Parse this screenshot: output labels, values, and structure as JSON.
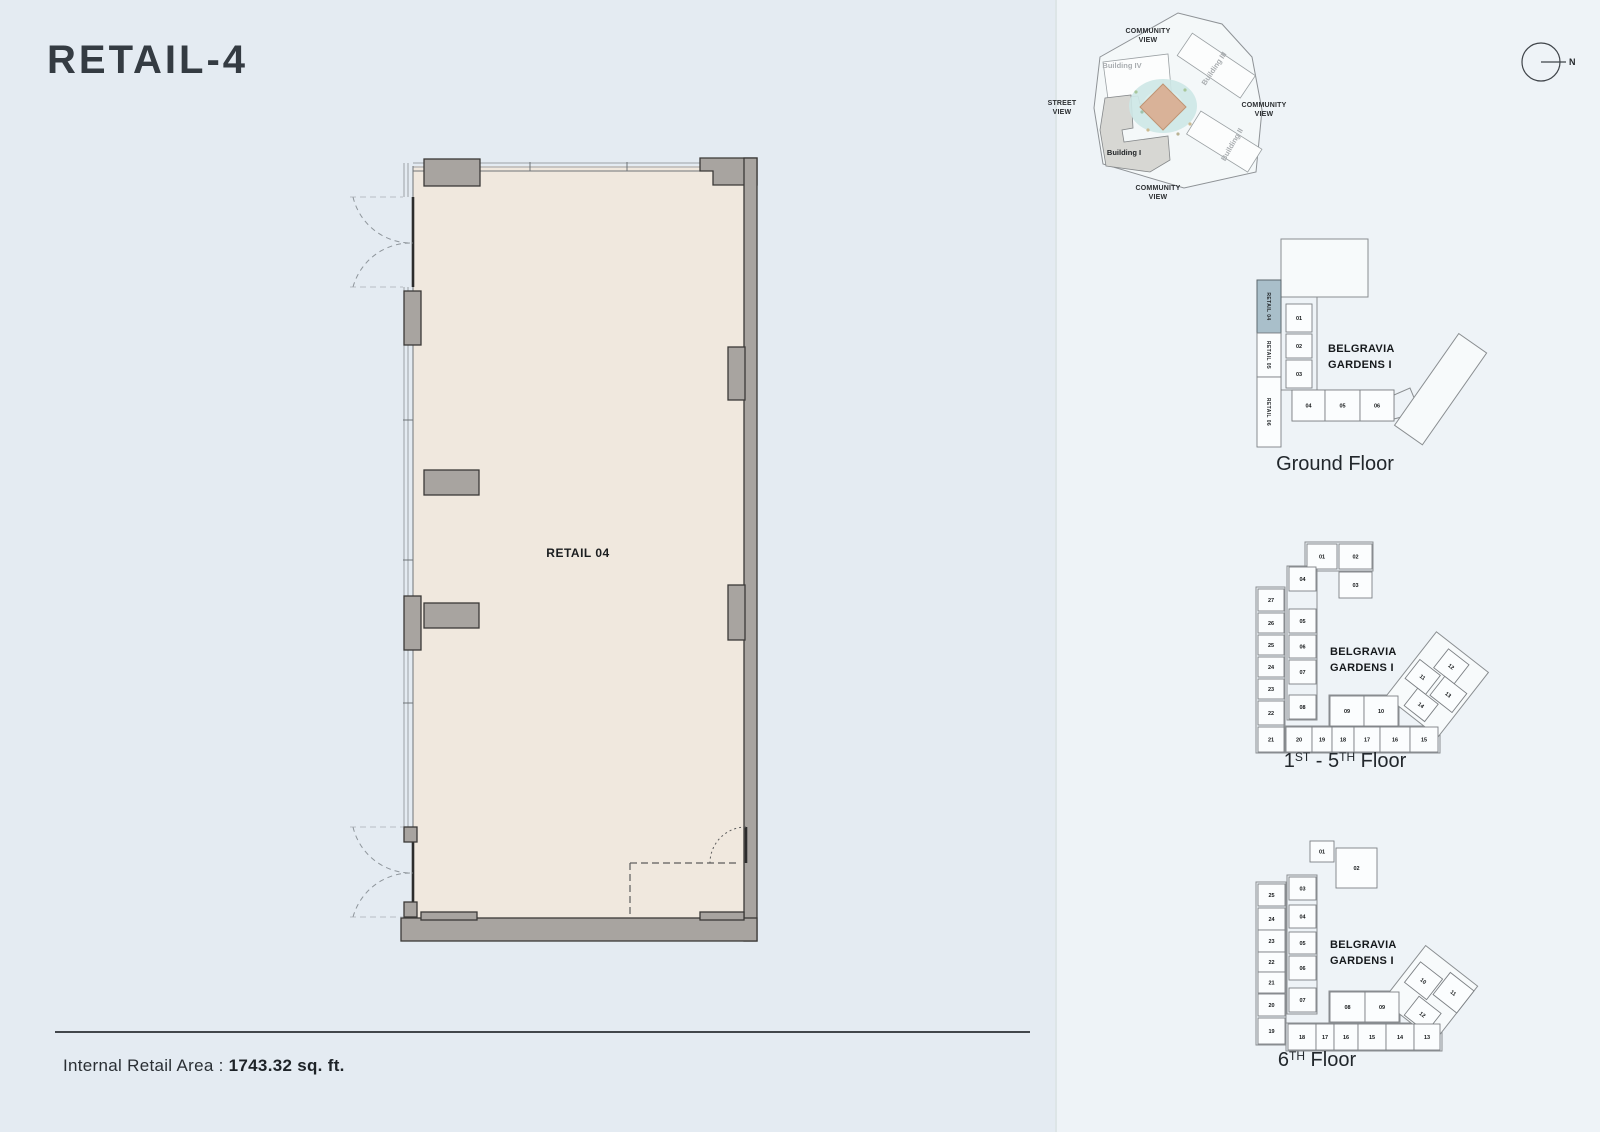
{
  "page": {
    "title": "RETAIL-4",
    "area_label": "Internal Retail Area :",
    "area_value": "1743.32 sq. ft."
  },
  "main_plan": {
    "unit_label": "RETAIL 04"
  },
  "site_plan": {
    "north_label": "N",
    "view_labels": {
      "top": "COMMUNITY\nVIEW",
      "left": "STREET\nVIEW",
      "right": "COMMUNITY\nVIEW",
      "bottom": "COMMUNITY\nVIEW"
    },
    "buildings": {
      "b1": "Building I",
      "b2": "Building II",
      "b3": "Building III",
      "b4": "Building IV"
    }
  },
  "colors": {
    "bg_left": "#e4ebf2",
    "bg_right": "#eef3f7",
    "plan_interior": "#f0e8de",
    "wall_gray": "#a8a4a0",
    "highlight_cell": "#a9bfca",
    "water": "#cde7e6",
    "center_building": "#d9b298"
  },
  "key_plans": {
    "ground": {
      "project_line1": "BELGRAVIA",
      "project_line2": "GARDENS I",
      "caption": "Ground Floor",
      "retail_cells": [
        {
          "l": "RETAIL 04",
          "x": 1257,
          "y": 280,
          "w": 24,
          "h": 53,
          "hl": true
        },
        {
          "l": "RETAIL 05",
          "x": 1257,
          "y": 333,
          "w": 24,
          "h": 44,
          "hl": false
        },
        {
          "l": "RETAIL 06",
          "x": 1257,
          "y": 377,
          "w": 24,
          "h": 70,
          "hl": false
        }
      ],
      "units": [
        {
          "l": "01",
          "x": 1286,
          "y": 304,
          "w": 26,
          "h": 28
        },
        {
          "l": "02",
          "x": 1286,
          "y": 334,
          "w": 26,
          "h": 24
        },
        {
          "l": "03",
          "x": 1286,
          "y": 360,
          "w": 26,
          "h": 28
        },
        {
          "l": "04",
          "x": 1292,
          "y": 390,
          "w": 33,
          "h": 31
        },
        {
          "l": "05",
          "x": 1325,
          "y": 390,
          "w": 35,
          "h": 31
        },
        {
          "l": "06",
          "x": 1360,
          "y": 390,
          "w": 34,
          "h": 31
        }
      ]
    },
    "f15": {
      "project_line1": "BELGRAVIA",
      "project_line2": "GARDENS I",
      "caption": {
        "n1": "1",
        "s1": "ST",
        "n2": "- 5",
        "s2": "TH",
        "rest": "Floor"
      },
      "units": [
        {
          "l": "01",
          "x": 1307,
          "y": 544,
          "w": 30,
          "h": 25
        },
        {
          "l": "02",
          "x": 1339,
          "y": 544,
          "w": 33,
          "h": 25
        },
        {
          "l": "03",
          "x": 1339,
          "y": 572,
          "w": 33,
          "h": 26
        },
        {
          "l": "04",
          "x": 1289,
          "y": 567,
          "w": 27,
          "h": 24
        },
        {
          "l": "05",
          "x": 1289,
          "y": 609,
          "w": 27,
          "h": 24
        },
        {
          "l": "06",
          "x": 1289,
          "y": 635,
          "w": 27,
          "h": 23
        },
        {
          "l": "07",
          "x": 1289,
          "y": 660,
          "w": 27,
          "h": 24
        },
        {
          "l": "08",
          "x": 1289,
          "y": 695,
          "w": 27,
          "h": 24
        },
        {
          "l": "09",
          "x": 1330,
          "y": 696,
          "w": 34,
          "h": 30
        },
        {
          "l": "10",
          "x": 1364,
          "y": 696,
          "w": 34,
          "h": 30
        },
        {
          "l": "27",
          "x": 1258,
          "y": 589,
          "w": 26,
          "h": 22
        },
        {
          "l": "26",
          "x": 1258,
          "y": 613,
          "w": 26,
          "h": 20
        },
        {
          "l": "25",
          "x": 1258,
          "y": 635,
          "w": 26,
          "h": 20
        },
        {
          "l": "24",
          "x": 1258,
          "y": 657,
          "w": 26,
          "h": 20
        },
        {
          "l": "23",
          "x": 1258,
          "y": 679,
          "w": 26,
          "h": 20
        },
        {
          "l": "22",
          "x": 1258,
          "y": 701,
          "w": 26,
          "h": 24
        },
        {
          "l": "21",
          "x": 1258,
          "y": 727,
          "w": 26,
          "h": 25
        },
        {
          "l": "20",
          "x": 1286,
          "y": 727,
          "w": 26,
          "h": 25
        },
        {
          "l": "19",
          "x": 1312,
          "y": 727,
          "w": 20,
          "h": 25
        },
        {
          "l": "18",
          "x": 1332,
          "y": 727,
          "w": 22,
          "h": 25
        },
        {
          "l": "17",
          "x": 1354,
          "y": 727,
          "w": 26,
          "h": 25
        },
        {
          "l": "16",
          "x": 1380,
          "y": 727,
          "w": 30,
          "h": 25
        },
        {
          "l": "15",
          "x": 1410,
          "y": 727,
          "w": 28,
          "h": 25
        }
      ],
      "wing_units": [
        {
          "l": "12",
          "x": -12,
          "y": -34,
          "w": 26,
          "h": 24
        },
        {
          "l": "11",
          "x": -28,
          "y": -8,
          "w": 26,
          "h": 24
        },
        {
          "l": "13",
          "x": 2,
          "y": -10,
          "w": 28,
          "h": 24
        },
        {
          "l": "14",
          "x": -12,
          "y": 16,
          "w": 26,
          "h": 22
        }
      ]
    },
    "f6": {
      "project_line1": "BELGRAVIA",
      "project_line2": "GARDENS I",
      "caption": {
        "n1": "6",
        "s1": "TH",
        "rest": "Floor"
      },
      "units": [
        {
          "l": "01",
          "x": 1310,
          "y": 841,
          "w": 24,
          "h": 21
        },
        {
          "l": "02",
          "x": 1336,
          "y": 848,
          "w": 41,
          "h": 40
        },
        {
          "l": "03",
          "x": 1289,
          "y": 877,
          "w": 27,
          "h": 23
        },
        {
          "l": "04",
          "x": 1289,
          "y": 905,
          "w": 27,
          "h": 23
        },
        {
          "l": "05",
          "x": 1289,
          "y": 932,
          "w": 27,
          "h": 22
        },
        {
          "l": "06",
          "x": 1289,
          "y": 956,
          "w": 27,
          "h": 24
        },
        {
          "l": "07",
          "x": 1289,
          "y": 988,
          "w": 27,
          "h": 24
        },
        {
          "l": "08",
          "x": 1330,
          "y": 992,
          "w": 35,
          "h": 30
        },
        {
          "l": "09",
          "x": 1365,
          "y": 992,
          "w": 34,
          "h": 30
        },
        {
          "l": "25",
          "x": 1258,
          "y": 884,
          "w": 27,
          "h": 22
        },
        {
          "l": "24",
          "x": 1258,
          "y": 908,
          "w": 27,
          "h": 22
        },
        {
          "l": "23",
          "x": 1258,
          "y": 930,
          "w": 27,
          "h": 22
        },
        {
          "l": "22",
          "x": 1258,
          "y": 952,
          "w": 27,
          "h": 20
        },
        {
          "l": "21",
          "x": 1258,
          "y": 972,
          "w": 27,
          "h": 21
        },
        {
          "l": "20",
          "x": 1258,
          "y": 994,
          "w": 27,
          "h": 22
        },
        {
          "l": "19",
          "x": 1258,
          "y": 1018,
          "w": 27,
          "h": 26
        },
        {
          "l": "18",
          "x": 1288,
          "y": 1024,
          "w": 28,
          "h": 26
        },
        {
          "l": "17",
          "x": 1316,
          "y": 1024,
          "w": 18,
          "h": 26
        },
        {
          "l": "16",
          "x": 1334,
          "y": 1024,
          "w": 24,
          "h": 26
        },
        {
          "l": "15",
          "x": 1358,
          "y": 1024,
          "w": 28,
          "h": 26
        },
        {
          "l": "14",
          "x": 1386,
          "y": 1024,
          "w": 28,
          "h": 26
        },
        {
          "l": "13",
          "x": 1414,
          "y": 1024,
          "w": 26,
          "h": 26
        }
      ],
      "wing_units": [
        {
          "l": "10",
          "x": -22,
          "y": -16,
          "w": 28,
          "h": 26
        },
        {
          "l": "11",
          "x": 8,
          "y": -26,
          "w": 30,
          "h": 28
        },
        {
          "l": "12",
          "x": -2,
          "y": 12,
          "w": 28,
          "h": 24
        }
      ]
    }
  }
}
